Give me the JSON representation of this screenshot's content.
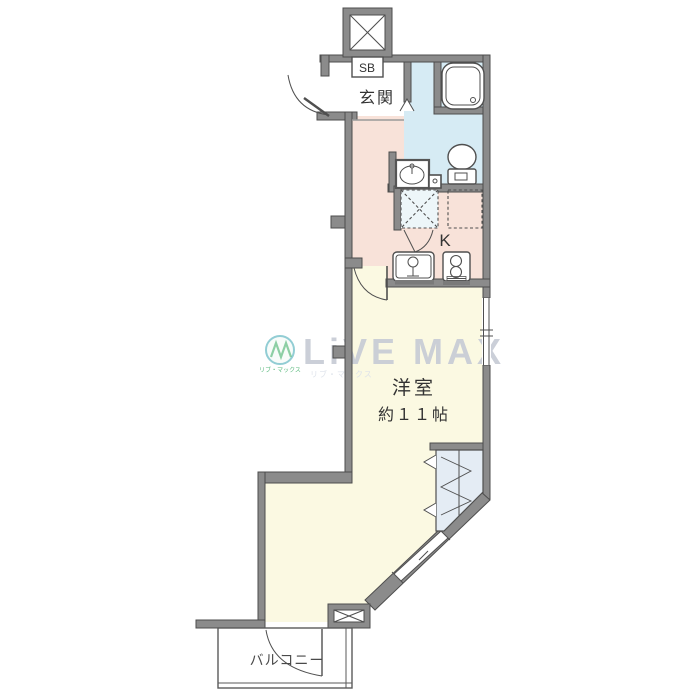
{
  "plan": {
    "labels": {
      "shoe_box": "SB",
      "entrance": "玄関",
      "kitchen": "K",
      "main_room_name": "洋室",
      "main_room_size": "約１１帖",
      "balcony": "バルコニー"
    },
    "watermark": {
      "brand": "LiVE MAX",
      "brand_sub": "リブ・マックス"
    },
    "colors": {
      "wall_fill": "#8b8b8b",
      "wall_edge": "#4d4d4d",
      "bathroom": "#d6ebf4",
      "kitchen": "#f8e2d9",
      "room": "#fbf9e2",
      "closet": "#e4ecf4",
      "washer_space": "#edf6f9",
      "line": "#4f4f4f",
      "watermark_text": "#c9cdd6",
      "watermark_logo_green": "#57b87b",
      "watermark_logo_teal": "#2e9fae",
      "label_text": "#333333"
    }
  }
}
